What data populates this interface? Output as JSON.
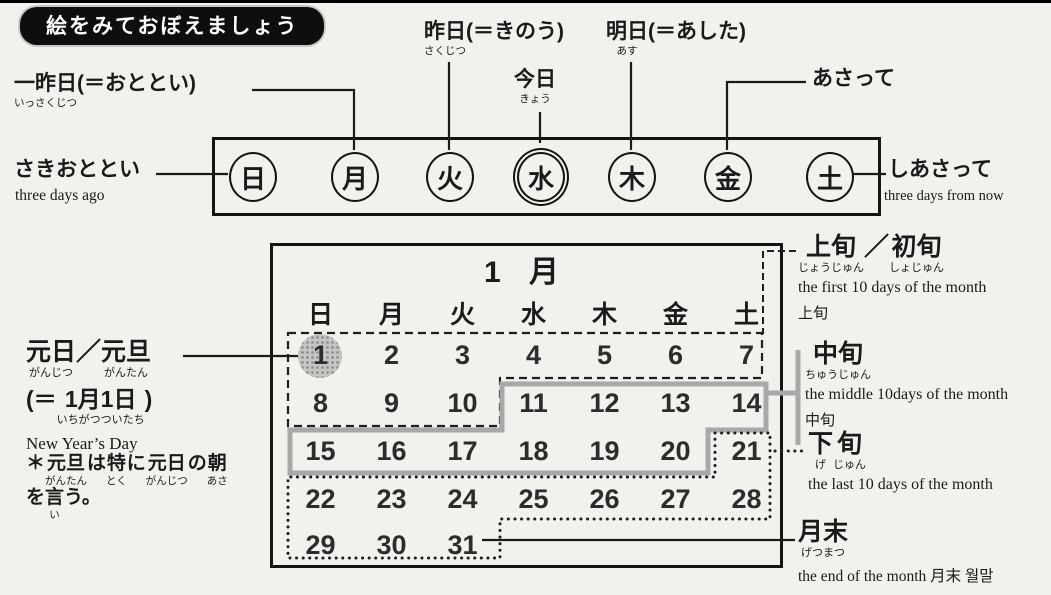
{
  "page": {
    "title": "絵をみておぼえましょう"
  },
  "week": {
    "days": [
      "日",
      "月",
      "火",
      "水",
      "木",
      "金",
      "土"
    ],
    "today_index": 3,
    "labels": {
      "issakujitsu": [
        {
          "t": "一昨日",
          "r": "いっさくじつ"
        },
        {
          "t": "(＝おととい)"
        }
      ],
      "sakujitsu": [
        {
          "t": "昨日",
          "r": "さくじつ"
        },
        {
          "t": "(＝きのう)"
        }
      ],
      "kyou": [
        {
          "t": "今日",
          "r": "きょう"
        }
      ],
      "asu": [
        {
          "t": "明日",
          "r": "あす"
        },
        {
          "t": "(＝あした)"
        }
      ],
      "asatte": "あさって",
      "sakiototoi": {
        "jp": "さきおととい",
        "en": "three days ago"
      },
      "shiasatte": {
        "jp": "しあさって",
        "en": "three days from now"
      }
    }
  },
  "calendar": {
    "month_title": "1 月",
    "weekday_headers": [
      "日",
      "月",
      "火",
      "水",
      "木",
      "金",
      "土"
    ],
    "weeks": [
      [
        1,
        2,
        3,
        4,
        5,
        6,
        7
      ],
      [
        8,
        9,
        10,
        11,
        12,
        13,
        14
      ],
      [
        15,
        16,
        17,
        18,
        19,
        20,
        21
      ],
      [
        22,
        23,
        24,
        25,
        26,
        27,
        28
      ],
      [
        29,
        30,
        31
      ]
    ],
    "highlighted_date": 1
  },
  "annotations": {
    "joujun": {
      "segments": [
        {
          "t": "上旬",
          "r": "じょうじゅん"
        },
        {
          "t": "／"
        },
        {
          "t": "初旬",
          "r": "しょじゅん"
        }
      ],
      "en": "the first 10 days of the month",
      "translation": "上旬"
    },
    "chuujun": {
      "segments": [
        {
          "t": "中旬",
          "r": "ちゅうじゅん"
        }
      ],
      "en": "the middle 10days of the month",
      "translation": "中旬"
    },
    "gejun": {
      "segments": [
        {
          "t": "下",
          "r": "げ"
        },
        {
          "t": "旬",
          "r": "じゅん"
        }
      ],
      "en": "the last 10 days of the month"
    },
    "getsumatsu": {
      "segments": [
        {
          "t": "月末",
          "r": "げつまつ"
        }
      ],
      "en": "the end of the month 月末 월말"
    },
    "ganjitsu": {
      "segments": [
        {
          "t": "元日",
          "r": "がんじつ"
        },
        {
          "t": "／"
        },
        {
          "t": "元旦",
          "r": "がんたん"
        }
      ],
      "equiv": [
        {
          "t": "(＝"
        },
        {
          "t": "1月1日",
          "r": "いちがつついたち"
        },
        {
          "t": ")"
        }
      ],
      "en": "New Year’s Day",
      "note": [
        {
          "t": "＊"
        },
        {
          "t": "元旦",
          "r": "がんたん"
        },
        {
          "t": "は"
        },
        {
          "t": "特",
          "r": "とく"
        },
        {
          "t": "に"
        },
        {
          "t": "元日",
          "r": "がんじつ"
        },
        {
          "t": "の"
        },
        {
          "t": "朝",
          "r": "あさ"
        },
        {
          "br": true
        },
        {
          "t": "を"
        },
        {
          "t": "言",
          "r": "い"
        },
        {
          "t": "う。"
        }
      ]
    }
  },
  "colors": {
    "ink": "#1a1a1a",
    "region_gray": "#a8a8a8",
    "highlight_gray": "#b7b7b7"
  }
}
